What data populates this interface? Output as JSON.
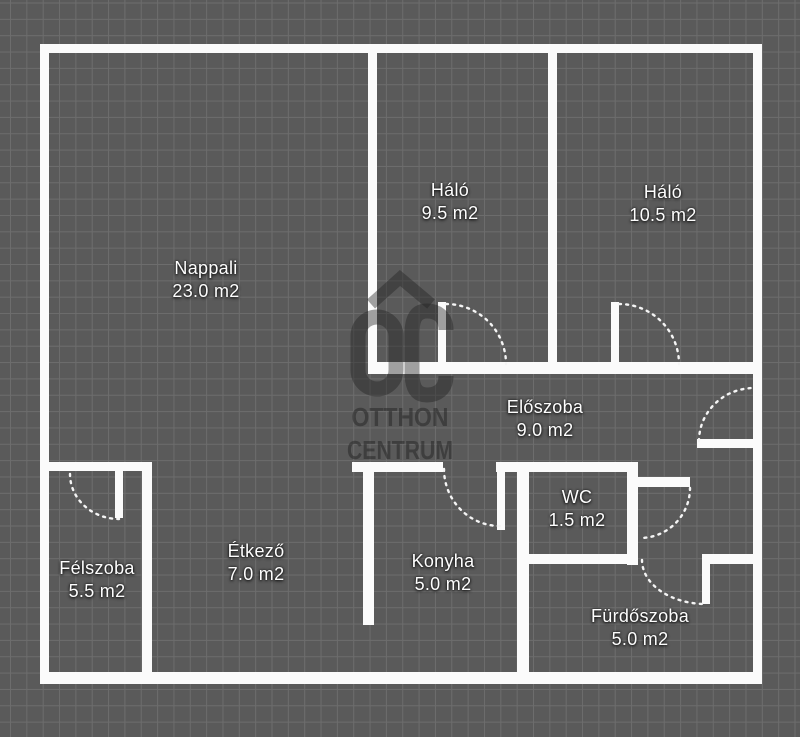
{
  "canvas": {
    "width": 800,
    "height": 737,
    "background_color": "#5a5a5a",
    "grid_color": "#6d6d6d",
    "wall_color": "#fbfbfb",
    "door_arc_color": "#f5f5f5",
    "watermark_color_rgba": "rgba(33,33,33,0.42)",
    "label_color": "#fdfdfd"
  },
  "watermark": {
    "logo_text": "OC",
    "line1": "OTTHON",
    "line2": "CENTRUM"
  },
  "rooms": [
    {
      "name": "Nappali",
      "area": "23.0 m2",
      "cx": 206,
      "cy": 268
    },
    {
      "name": "Háló",
      "area": "9.5 m2",
      "cx": 450,
      "cy": 190
    },
    {
      "name": "Háló",
      "area": "10.5 m2",
      "cx": 663,
      "cy": 192
    },
    {
      "name": "Előszoba",
      "area": "9.0 m2",
      "cx": 545,
      "cy": 407
    },
    {
      "name": "Félszoba",
      "area": "5.5 m2",
      "cx": 97,
      "cy": 568
    },
    {
      "name": "Étkező",
      "area": "7.0 m2",
      "cx": 256,
      "cy": 551
    },
    {
      "name": "Konyha",
      "area": "5.0 m2",
      "cx": 443,
      "cy": 561
    },
    {
      "name": "WC",
      "area": "1.5 m2",
      "cx": 577,
      "cy": 497
    },
    {
      "name": "Fürdőszoba",
      "area": "5.0 m2",
      "cx": 640,
      "cy": 616
    }
  ],
  "plan": {
    "walls": [
      [
        40,
        44,
        722,
        9
      ],
      [
        40,
        44,
        9,
        640
      ],
      [
        753,
        44,
        9,
        640
      ],
      [
        40,
        672,
        722,
        12
      ],
      [
        368,
        44,
        9,
        330
      ],
      [
        548,
        44,
        9,
        330
      ],
      [
        368,
        362,
        394,
        12
      ],
      [
        352,
        462,
        91,
        10
      ],
      [
        496,
        462,
        142,
        10
      ],
      [
        363,
        462,
        11,
        163
      ],
      [
        517,
        462,
        12,
        222
      ],
      [
        627,
        462,
        11,
        103
      ],
      [
        517,
        554,
        121,
        10
      ],
      [
        702,
        554,
        60,
        10
      ],
      [
        638,
        477,
        52,
        10
      ],
      [
        697,
        439,
        65,
        9
      ],
      [
        47,
        462,
        105,
        9
      ],
      [
        142,
        462,
        10,
        222
      ]
    ],
    "door_leaves": [
      [
        438,
        302,
        8,
        64
      ],
      [
        611,
        302,
        8,
        64
      ],
      [
        497,
        470,
        8,
        60
      ],
      [
        702,
        554,
        8,
        50
      ],
      [
        115,
        470,
        8,
        48
      ]
    ],
    "door_arcs": [
      "M 446,304 A 60,60 0 0 1 506,364",
      "M 619,304 A 60,60 0 0 1 679,364",
      "M 444,469 A 56,57 0 0 0 500,526",
      "M 642,560 A 64,44 0 0 0 706,604",
      "M 690,488 A 50,50 0 0 1 640,538",
      "M 699,441 A 55,53 0 0 1 754,388",
      "M 70,474 A 49,45 0 0 0 119,519"
    ]
  }
}
